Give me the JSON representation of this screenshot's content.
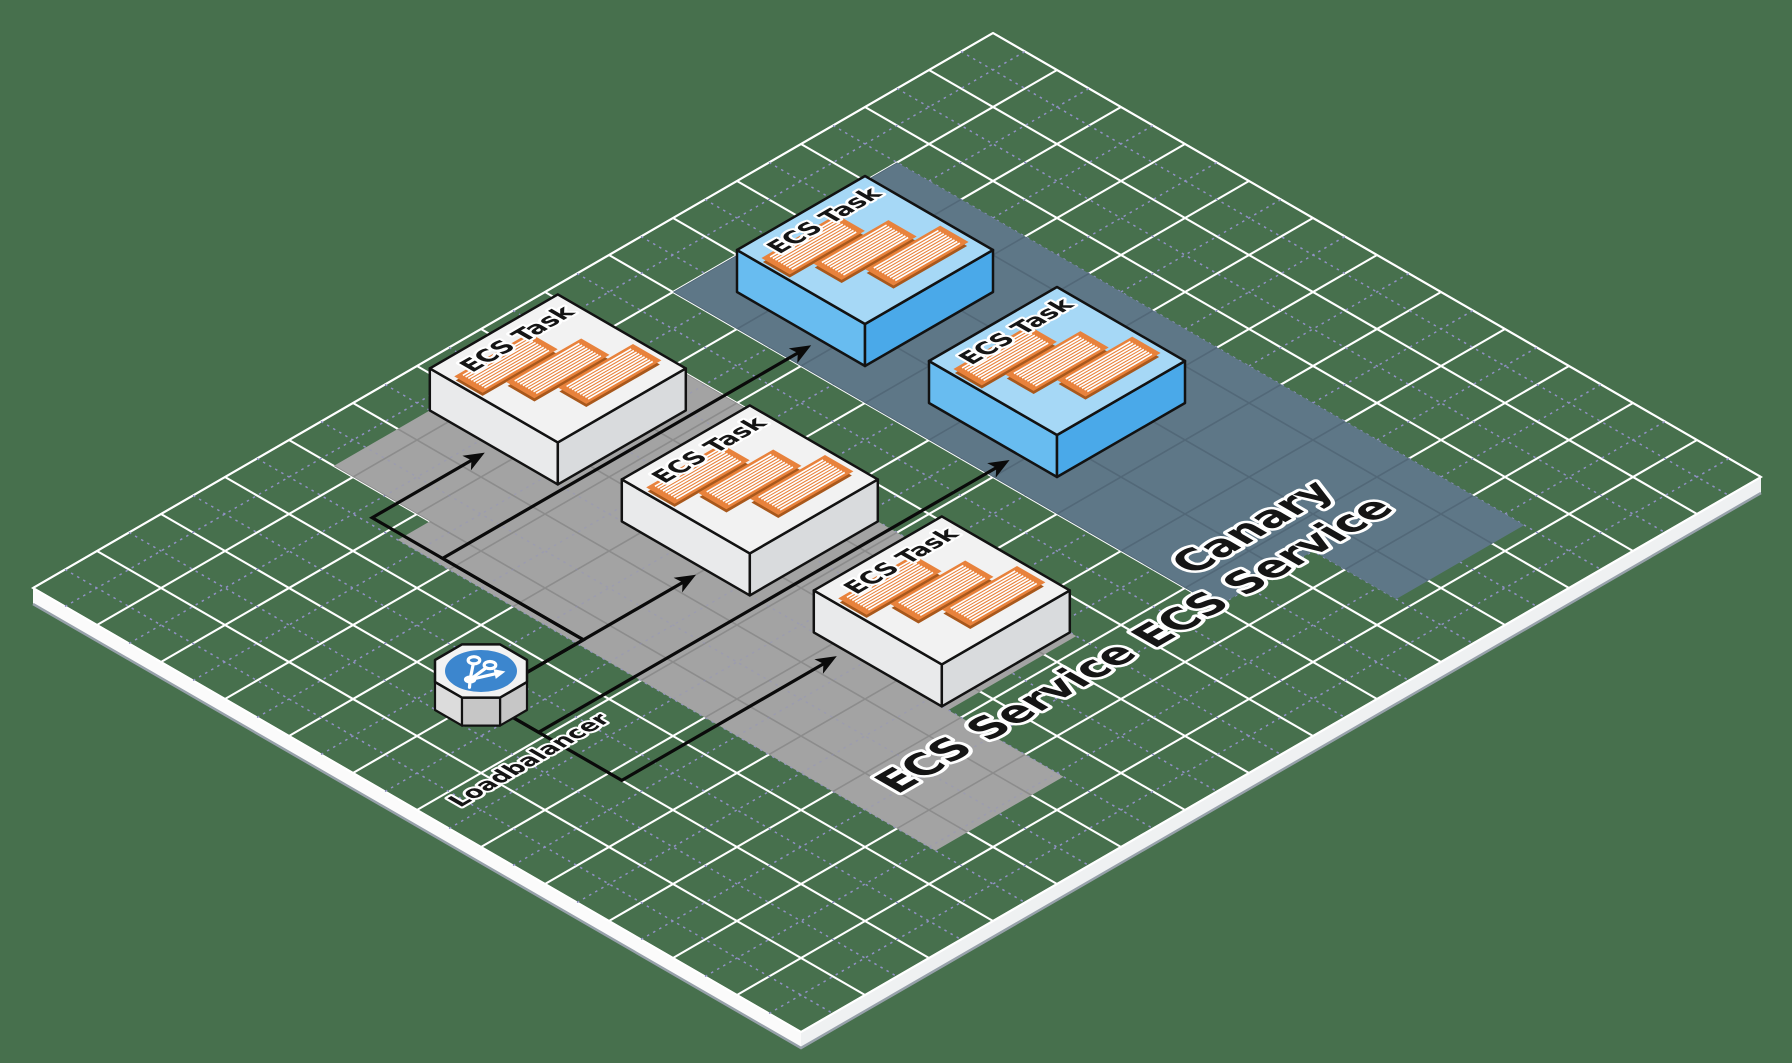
{
  "diagram": {
    "colors": {
      "background": "#47704D",
      "grid_major": "#FFFFFF",
      "grid_minor": "#9191C5",
      "platform_side_left": "#FBFBFB",
      "platform_side_right": "#EFF1F2",
      "platform_side_shadow": "#97A1AA",
      "ecs_band": "#A3A3A3",
      "ecs_band_grid": "#8C8C8C",
      "canary_band": "#5E7787",
      "canary_band_grid": "#526878",
      "task_top": "#F2F2F2",
      "task_left": "#E9EAEB",
      "task_right": "#D9DBDD",
      "canary_task_top": "#A6D8F6",
      "canary_task_left": "#68BCF0",
      "canary_task_right": "#4AA9E9",
      "outline": "#121212",
      "container_fill": "#E8823C",
      "container_shadow": "#A8581C",
      "container_stripe": "#FFFFFF",
      "lb_top": "#F2F2F2",
      "lb_side_left": "#DCDCDC",
      "lb_side_right": "#C6C6C6",
      "lb_badge": "#3C86CE",
      "lb_icon": "#FFFFFF",
      "arrow": "#0A0A0A",
      "label_fill": "#151515",
      "label_outline": "#FFFFFF"
    },
    "grid": {
      "cells_a": 15,
      "cells_b": 12
    },
    "services": [
      {
        "id": "ecs-service",
        "name_lines": [
          "ECS Service"
        ],
        "band": [
          [
            4,
            0.7
          ],
          [
            8,
            0.7
          ],
          [
            8,
            3.2
          ],
          [
            7.5,
            3.2
          ],
          [
            7.5,
            8.8
          ],
          [
            5.5,
            8.8
          ],
          [
            5.5,
            10.6
          ],
          [
            3.5,
            10.6
          ],
          [
            3.5,
            2.2
          ],
          [
            4,
            2.2
          ]
        ],
        "label_positions": [
          {
            "a": 5.85,
            "b": 9.35
          }
        ]
      },
      {
        "id": "canary-ecs-service",
        "name_lines": [
          "Canary",
          "ECS Service"
        ],
        "band": [
          [
            9,
            1
          ],
          [
            12.5,
            1
          ],
          [
            12.5,
            10.8
          ],
          [
            10.5,
            10.8
          ],
          [
            10.5,
            9.5
          ],
          [
            9,
            9.5
          ]
        ],
        "label_positions": [
          {
            "a": 10.35,
            "b": 8.7
          },
          {
            "a": 9.82,
            "b": 9.39
          }
        ]
      }
    ],
    "loadbalancer": {
      "label": "Loadbalancer",
      "a": 2.0,
      "b": 5.0,
      "label_pos": {
        "a": 1.55,
        "b": 6.2
      }
    },
    "tasks": [
      {
        "label": "ECS Task",
        "service": "ecs-service",
        "a": 6.5,
        "b": 1.7
      },
      {
        "label": "ECS Task",
        "service": "ecs-service",
        "a": 6.5,
        "b": 4.7
      },
      {
        "label": "ECS Task",
        "service": "ecs-service",
        "a": 6.5,
        "b": 7.7
      },
      {
        "label": "ECS Task",
        "service": "canary-ecs-service",
        "a": 10.5,
        "b": 2.5
      },
      {
        "label": "ECS Task",
        "service": "canary-ecs-service",
        "a": 10.5,
        "b": 5.5
      }
    ],
    "arrows": [
      {
        "to": 0,
        "path": [
          [
            2.0,
            5.0
          ],
          [
            3.6,
            5.0
          ],
          [
            3.6,
            1.7
          ],
          [
            5.36,
            1.7
          ]
        ]
      },
      {
        "to": 1,
        "path": [
          [
            2.0,
            5.0
          ],
          [
            5.36,
            5.0
          ]
        ]
      },
      {
        "to": 2,
        "path": [
          [
            2.0,
            5.0
          ],
          [
            2.0,
            7.2
          ],
          [
            5.36,
            7.2
          ]
        ]
      },
      {
        "to": 3,
        "path": [
          [
            2.0,
            5.0
          ],
          [
            3.6,
            5.0
          ],
          [
            3.6,
            2.8
          ],
          [
            9.36,
            2.8
          ]
        ]
      },
      {
        "to": 4,
        "path": [
          [
            2.0,
            5.0
          ],
          [
            2.0,
            5.9
          ],
          [
            9.36,
            5.9
          ]
        ]
      }
    ]
  }
}
